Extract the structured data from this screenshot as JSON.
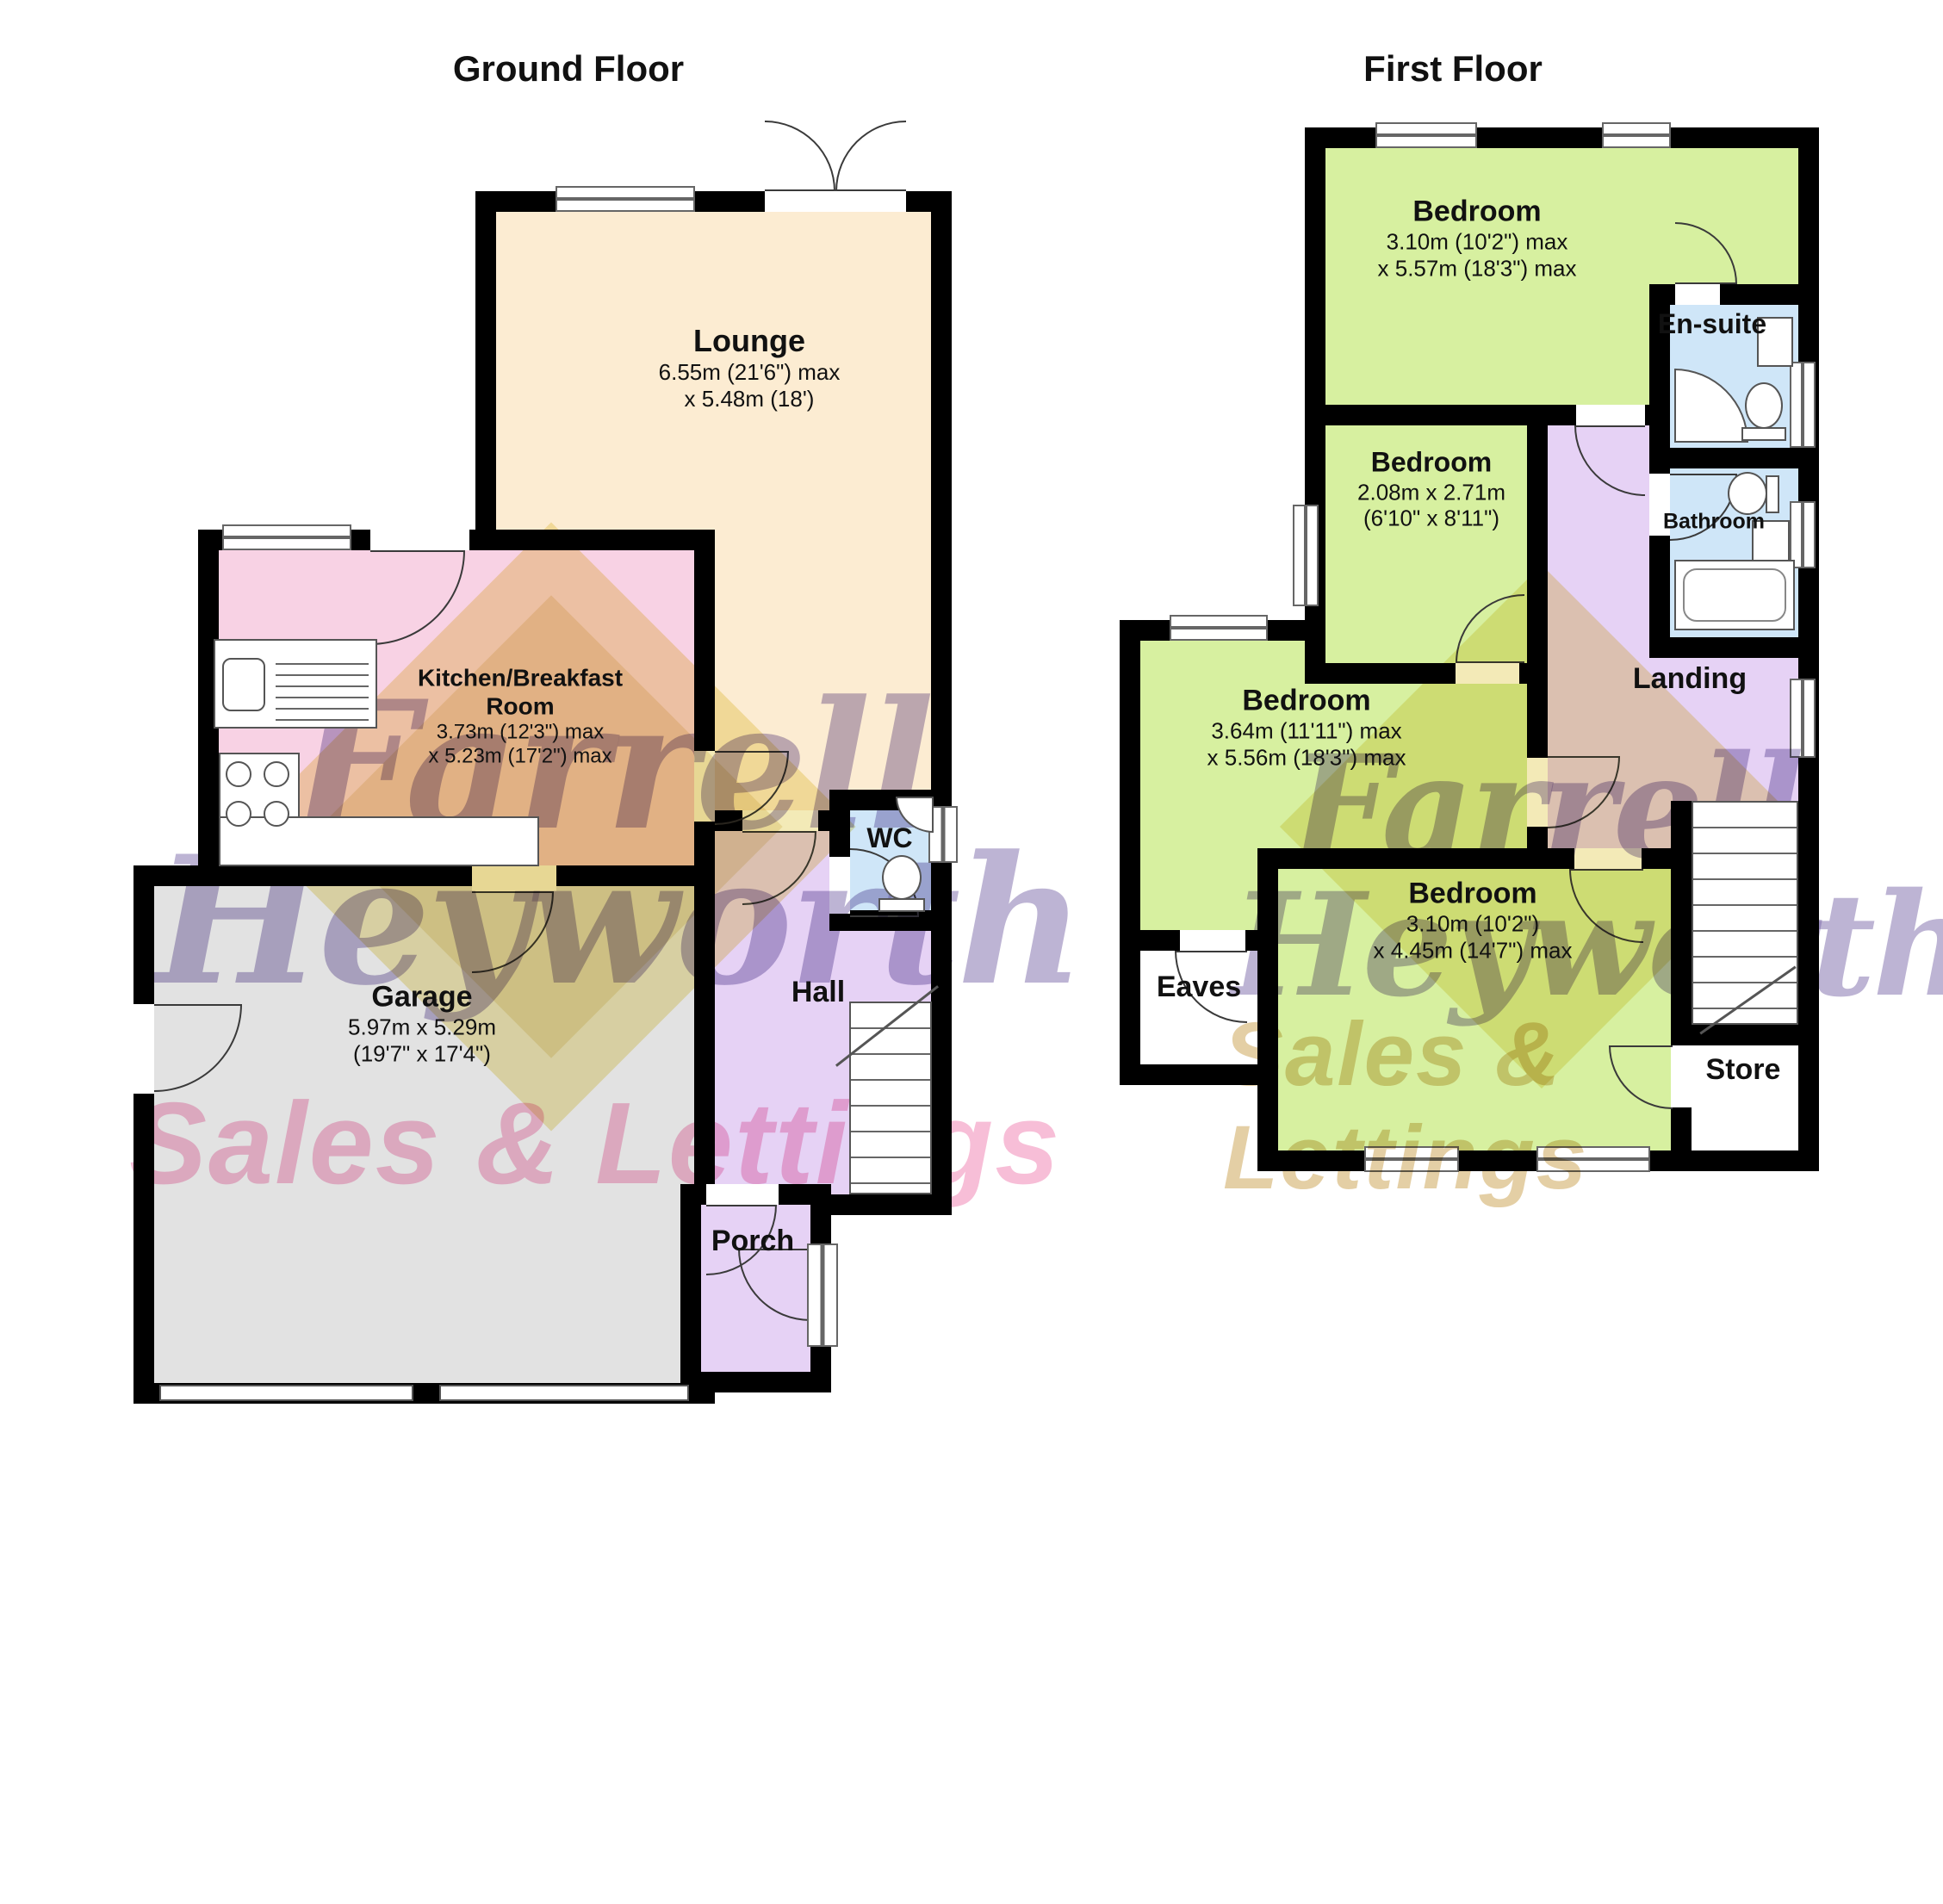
{
  "titles": {
    "ground": "Ground Floor",
    "first": "First Floor"
  },
  "watermark": {
    "name_line1": "Farrell",
    "name_line2": "Heyworth",
    "tagline": "Sales & Lettings"
  },
  "colors": {
    "lounge": "#fcecd2",
    "kitchen": "#f8d2e4",
    "garage": "#e2e2e2",
    "hall_landing_porch": "#e6d2f5",
    "bathrooms_wc": "#cfe6f8",
    "bedrooms": "#d7f0a0",
    "walls": "#000000",
    "watermark_purple": "#7c6aaa",
    "watermark_pink": "#f07daf",
    "watermark_yellow": "#e9d87c"
  },
  "ground": {
    "lounge": {
      "name": "Lounge",
      "dim1": "6.55m (21'6\") max",
      "dim2": "x 5.48m (18')"
    },
    "kitchen": {
      "name": "Kitchen/Breakfast Room",
      "dim1": "3.73m (12'3\") max",
      "dim2": "x 5.23m (17'2\") max"
    },
    "garage": {
      "name": "Garage",
      "dim1": "5.97m x 5.29m",
      "dim2": "(19'7\" x 17'4\")"
    },
    "hall": {
      "name": "Hall"
    },
    "wc": {
      "name": "WC"
    },
    "porch": {
      "name": "Porch"
    }
  },
  "first": {
    "bedroom1": {
      "name": "Bedroom",
      "dim1": "3.10m (10'2\") max",
      "dim2": "x 5.57m (18'3\") max"
    },
    "bedroom2": {
      "name": "Bedroom",
      "dim1": "2.08m x 2.71m",
      "dim2": "(6'10\" x 8'11\")"
    },
    "bedroom3": {
      "name": "Bedroom",
      "dim1": "3.64m (11'11\") max",
      "dim2": "x 5.56m (18'3\") max"
    },
    "bedroom4": {
      "name": "Bedroom",
      "dim1": "3.10m (10'2\")",
      "dim2": "x 4.45m (14'7\") max"
    },
    "ensuite": {
      "name": "En-suite"
    },
    "bathroom": {
      "name": "Bathroom"
    },
    "landing": {
      "name": "Landing"
    },
    "eaves": {
      "name": "Eaves"
    },
    "store": {
      "name": "Store"
    }
  }
}
